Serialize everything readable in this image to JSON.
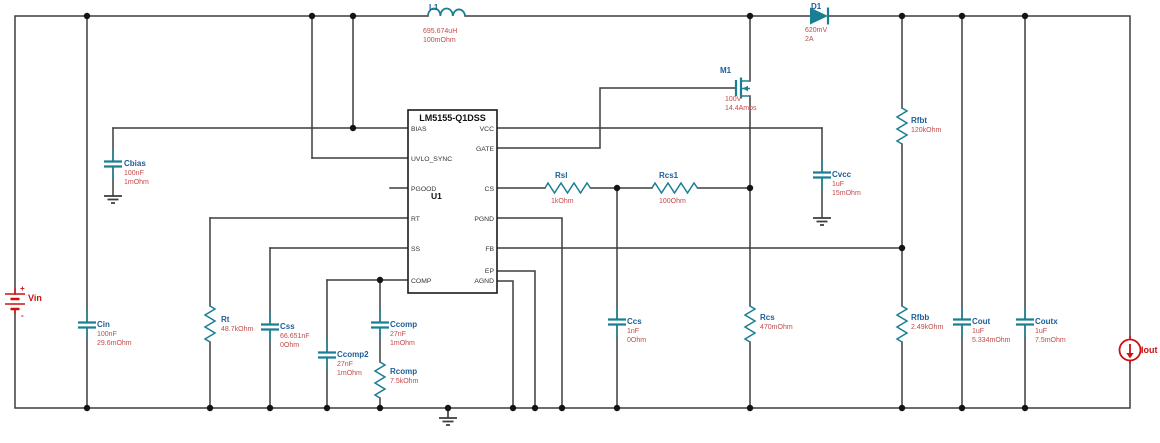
{
  "colors": {
    "wire": "#3d3d3d",
    "junction": "#141414",
    "symbol": "#1b7f93",
    "name": "#1c5d99",
    "value": "#c34a4a",
    "source": "#cc1111",
    "ic-border": "#1a1a1a",
    "background": "#ffffff"
  },
  "ic": {
    "title": "LM5155-Q1DSS",
    "designator": "U1",
    "left_pins": [
      "BIAS",
      "UVLO_SYNC",
      "PGOOD",
      "RT",
      "SS",
      "COMP"
    ],
    "right_pins": [
      "VCC",
      "GATE",
      "CS",
      "PGND",
      "FB",
      "EP",
      "AGND"
    ]
  },
  "source_symbols": {
    "plus": "+",
    "minus": "-"
  },
  "components": {
    "L1": {
      "name": "L1",
      "values": [
        "695.674uH",
        "100mOhm"
      ]
    },
    "D1": {
      "name": "D1",
      "values": [
        "620mV",
        "2A"
      ]
    },
    "M1": {
      "name": "M1",
      "values": [
        "100V",
        "14.4Amps"
      ]
    },
    "Vin": {
      "name": "Vin"
    },
    "Iout": {
      "name": "Iout"
    },
    "Cbias": {
      "name": "Cbias",
      "values": [
        "100nF",
        "1mOhm"
      ]
    },
    "Cin": {
      "name": "Cin",
      "values": [
        "100nF",
        "29.6mOhm"
      ]
    },
    "Rt": {
      "name": "Rt",
      "values": [
        "48.7kOhm"
      ]
    },
    "Css": {
      "name": "Css",
      "values": [
        "66.651nF",
        "0Ohm"
      ]
    },
    "Ccomp2": {
      "name": "Ccomp2",
      "values": [
        "27nF",
        "1mOhm"
      ]
    },
    "Ccomp": {
      "name": "Ccomp",
      "values": [
        "27nF",
        "1mOhm"
      ]
    },
    "Rcomp": {
      "name": "Rcomp",
      "values": [
        "7.5kOhm"
      ]
    },
    "Rsl": {
      "name": "Rsl",
      "values": [
        "1kOhm"
      ]
    },
    "Rcs1": {
      "name": "Rcs1",
      "values": [
        "100Ohm"
      ]
    },
    "Ccs": {
      "name": "Ccs",
      "values": [
        "1nF",
        "0Ohm"
      ]
    },
    "Rcs": {
      "name": "Rcs",
      "values": [
        "470mOhm"
      ]
    },
    "Cvcc": {
      "name": "Cvcc",
      "values": [
        "1uF",
        "15mOhm"
      ]
    },
    "Rfbt": {
      "name": "Rfbt",
      "values": [
        "120kOhm"
      ]
    },
    "Rfbb": {
      "name": "Rfbb",
      "values": [
        "2.49kOhm"
      ]
    },
    "Cout": {
      "name": "Cout",
      "values": [
        "1uF",
        "5.334mOhm"
      ]
    },
    "Coutx": {
      "name": "Coutx",
      "values": [
        "1uF",
        "7.5mOhm"
      ]
    }
  }
}
